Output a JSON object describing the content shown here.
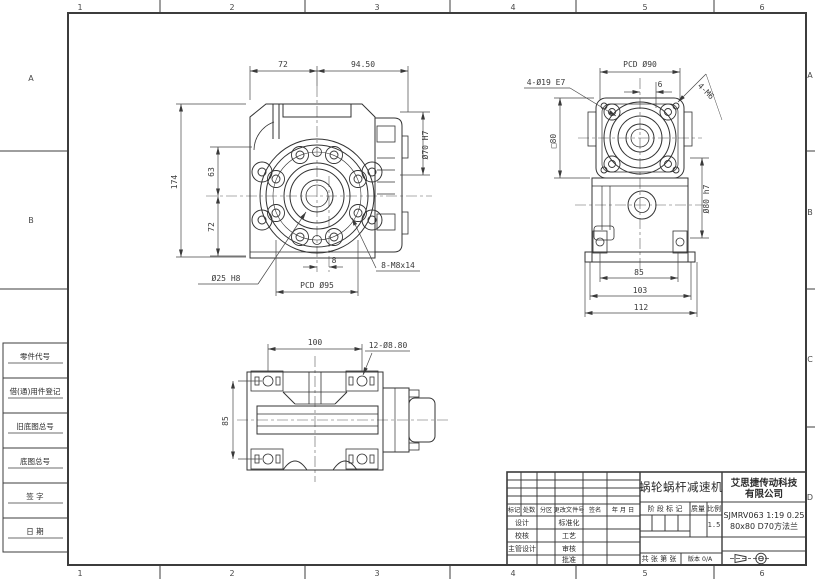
{
  "sheet": {
    "cols": [
      "1",
      "2",
      "3",
      "4",
      "5",
      "6"
    ],
    "rows_left": [
      "A",
      "B"
    ],
    "rows_right": [
      "A",
      "B",
      "C",
      "D"
    ]
  },
  "left_block": {
    "labels": [
      "零件代号",
      "借(通)用件登记",
      "旧底图总号",
      "底图总号",
      "签  字",
      "日  期"
    ]
  },
  "title_block": {
    "part_name": "蜗轮蜗杆减速机",
    "company_line1": "艾思捷传动科技",
    "company_line2": "有限公司",
    "code_line1": "SJMRV063 1:19 0.25",
    "code_line2": "80x80 D70方法兰",
    "rev_cols": {
      "mark": "标记",
      "count": "处数",
      "zone": "分区",
      "doc": "更改文件号",
      "sign": "签名",
      "date": "年 月 日"
    },
    "roles": {
      "design": "设计",
      "check": "校核",
      "chief": "主管设计",
      "standard": "标准化",
      "process": "工艺",
      "audit": "审核",
      "approve": "批准"
    },
    "stage": {
      "header": "阶 段 标 记",
      "mass": "质量",
      "scale": "比例",
      "scale_value": "1.5"
    },
    "sheet_info": "共  张  第  张",
    "version": "版本 0/A"
  },
  "views": {
    "front": {
      "dim_top_left": "72",
      "dim_top_right": "94.50",
      "dim_height": "174",
      "dim_upper": "63",
      "dim_lower": "72",
      "dim_input": "Ø70 H7",
      "dim_bore": "Ø25 H8",
      "dim_pcd": "PCD Ø95",
      "dim_offset": "8",
      "dim_holes": "8-M8x14"
    },
    "side": {
      "dim_pcd": "PCD Ø90",
      "dim_offset": "6",
      "dim_holes": "4-Ø19 E7",
      "dim_tapped": "4-M6",
      "dim_square": "□80",
      "dim_spigot": "Ø80 h7",
      "dim_w1": "85",
      "dim_w2": "103",
      "dim_w3": "112"
    },
    "bottom": {
      "dim_length": "100",
      "dim_holes": "12-Ø8.80",
      "dim_width": "85"
    }
  }
}
